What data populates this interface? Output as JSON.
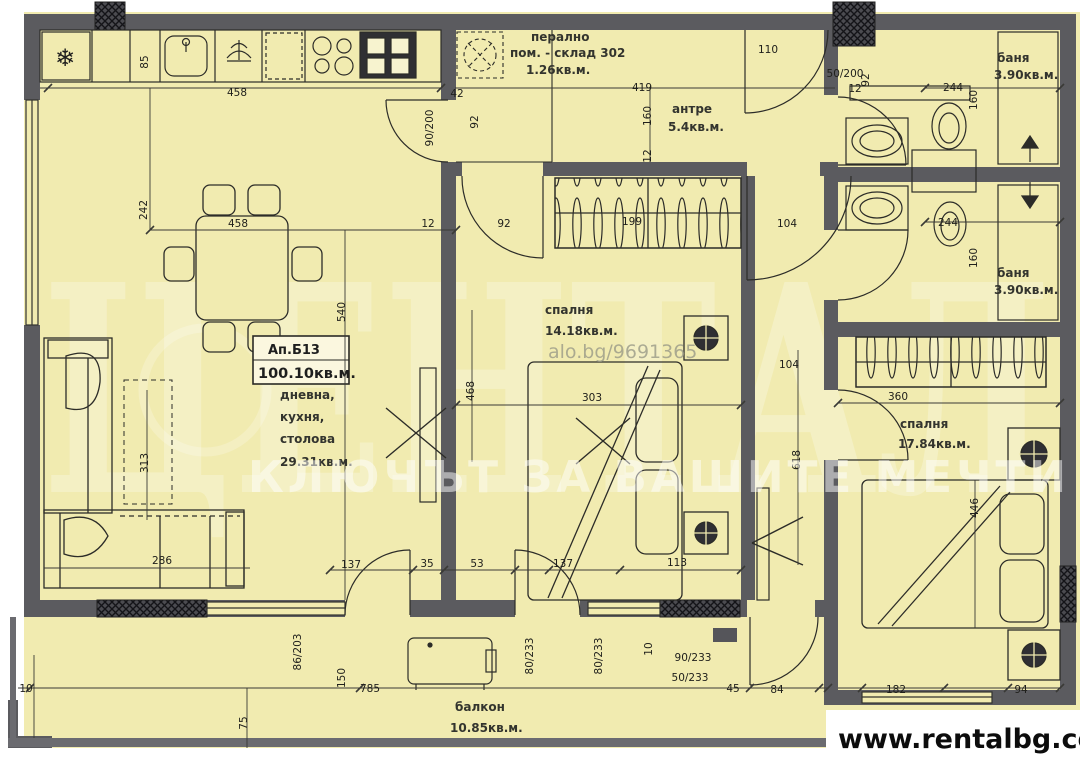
{
  "apartment": {
    "id": "Ап.Б13",
    "total_area": "100.10кв.м."
  },
  "rooms": {
    "laundry": {
      "l1": "перално",
      "l2": "пом. - склад 302",
      "area": "1.26кв.м."
    },
    "hall": {
      "name": "антре",
      "area": "5.4кв.м."
    },
    "bath1": {
      "name": "баня",
      "area": "3.90кв.м."
    },
    "bath2": {
      "name": "баня",
      "area": "3.90кв.м."
    },
    "bedroom1": {
      "name": "спалня",
      "area": "14.18кв.м."
    },
    "bedroom2": {
      "name": "спалня",
      "area": "17.84кв.м."
    },
    "living": {
      "l1": "дневна,",
      "l2": "кухня,",
      "l3": "столова",
      "area": "29.31кв.м."
    },
    "balcony": {
      "name": "балкон",
      "area": "10.85кв.м."
    }
  },
  "icons": {
    "fridge": "❄"
  },
  "watermark": {
    "brand": "ЦЕНТАЛ",
    "slogan": "КЛЮЧЪТ ЗА ВАШИТЕ МЕЧТИ",
    "listing": "alo.bg/9691365"
  },
  "footer": {
    "url": "www.rentalbg.com"
  },
  "dims": [
    {
      "t": "458",
      "x": 237,
      "y": 96
    },
    {
      "t": "85",
      "x": 148,
      "y": 62,
      "r": -90
    },
    {
      "t": "42",
      "x": 457,
      "y": 97
    },
    {
      "t": "90/200",
      "x": 433,
      "y": 128,
      "r": -90
    },
    {
      "t": "92",
      "x": 478,
      "y": 122,
      "r": -90
    },
    {
      "t": "419",
      "x": 642,
      "y": 91
    },
    {
      "t": "160",
      "x": 651,
      "y": 116,
      "r": -90
    },
    {
      "t": "12",
      "x": 651,
      "y": 156,
      "r": -90
    },
    {
      "t": "110",
      "x": 768,
      "y": 53
    },
    {
      "t": "50/200",
      "x": 845,
      "y": 77
    },
    {
      "t": "92",
      "x": 869,
      "y": 80,
      "r": -90
    },
    {
      "t": "12",
      "x": 855,
      "y": 92
    },
    {
      "t": "244",
      "x": 953,
      "y": 91
    },
    {
      "t": "160",
      "x": 977,
      "y": 100,
      "r": -90
    },
    {
      "t": "244",
      "x": 948,
      "y": 226
    },
    {
      "t": "160",
      "x": 977,
      "y": 258,
      "r": -90
    },
    {
      "t": "104",
      "x": 787,
      "y": 227
    },
    {
      "t": "199",
      "x": 632,
      "y": 225
    },
    {
      "t": "242",
      "x": 147,
      "y": 210,
      "r": -90
    },
    {
      "t": "458",
      "x": 238,
      "y": 227
    },
    {
      "t": "540",
      "x": 345,
      "y": 312,
      "r": -90
    },
    {
      "t": "12",
      "x": 428,
      "y": 227
    },
    {
      "t": "92",
      "x": 504,
      "y": 227
    },
    {
      "t": "303",
      "x": 592,
      "y": 401
    },
    {
      "t": "468",
      "x": 474,
      "y": 391,
      "r": -90
    },
    {
      "t": "313",
      "x": 148,
      "y": 463,
      "r": -90
    },
    {
      "t": "286",
      "x": 162,
      "y": 564
    },
    {
      "t": "137",
      "x": 351,
      "y": 568
    },
    {
      "t": "35",
      "x": 427,
      "y": 567
    },
    {
      "t": "53",
      "x": 477,
      "y": 567
    },
    {
      "t": "137",
      "x": 563,
      "y": 567
    },
    {
      "t": "113",
      "x": 677,
      "y": 566
    },
    {
      "t": "618",
      "x": 800,
      "y": 460,
      "r": -90
    },
    {
      "t": "104",
      "x": 789,
      "y": 368
    },
    {
      "t": "360",
      "x": 898,
      "y": 400
    },
    {
      "t": "446",
      "x": 978,
      "y": 508,
      "r": -90
    },
    {
      "t": "10",
      "x": 26,
      "y": 692
    },
    {
      "t": "785",
      "x": 370,
      "y": 692
    },
    {
      "t": "150",
      "x": 345,
      "y": 678,
      "r": -90
    },
    {
      "t": "75",
      "x": 247,
      "y": 723,
      "r": -90
    },
    {
      "t": "86/203",
      "x": 301,
      "y": 652,
      "r": -90
    },
    {
      "t": "80/233",
      "x": 533,
      "y": 656,
      "r": -90
    },
    {
      "t": "80/233",
      "x": 602,
      "y": 656,
      "r": -90
    },
    {
      "t": "10",
      "x": 652,
      "y": 649,
      "r": -90
    },
    {
      "t": "50/233",
      "x": 690,
      "y": 681
    },
    {
      "t": "90/233",
      "x": 693,
      "y": 661
    },
    {
      "t": "45",
      "x": 733,
      "y": 692
    },
    {
      "t": "84",
      "x": 777,
      "y": 693
    },
    {
      "t": "182",
      "x": 896,
      "y": 693
    },
    {
      "t": "94",
      "x": 1021,
      "y": 693
    }
  ]
}
